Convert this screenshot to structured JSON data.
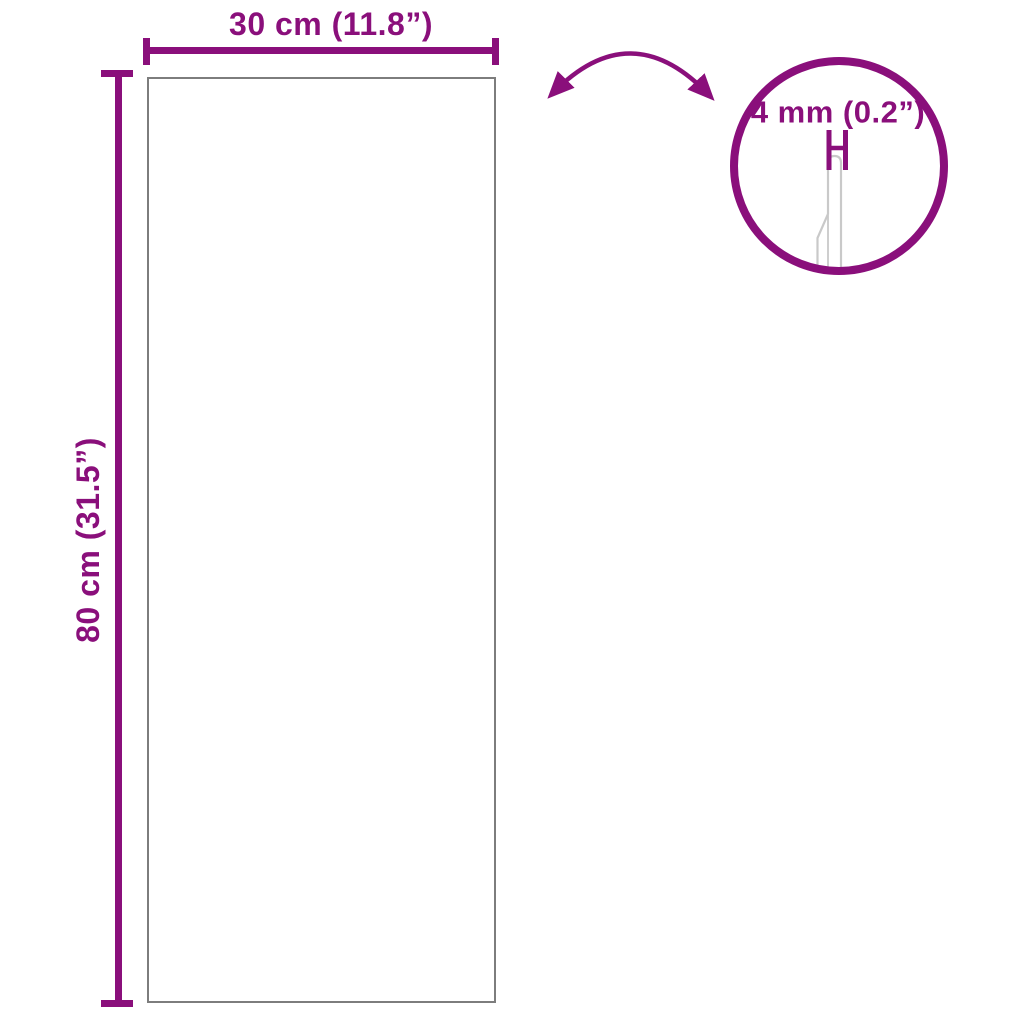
{
  "diagram": {
    "width_label": "30 cm (11.8”)",
    "height_label": "80 cm (31.5”)",
    "thickness_label": "4 mm (0.2”)"
  },
  "icons": {
    "rotate_arrow": "curved-double-headed-arrow",
    "zoom_circle": "magnified-edge-detail-circle",
    "thickness_marker": "h-shaped-dimension-marker"
  },
  "colors": {
    "accent": "#8a0f7b",
    "panel_outline": "#7d7d7d",
    "detail_line": "#c9c9c9",
    "background": "#ffffff"
  }
}
